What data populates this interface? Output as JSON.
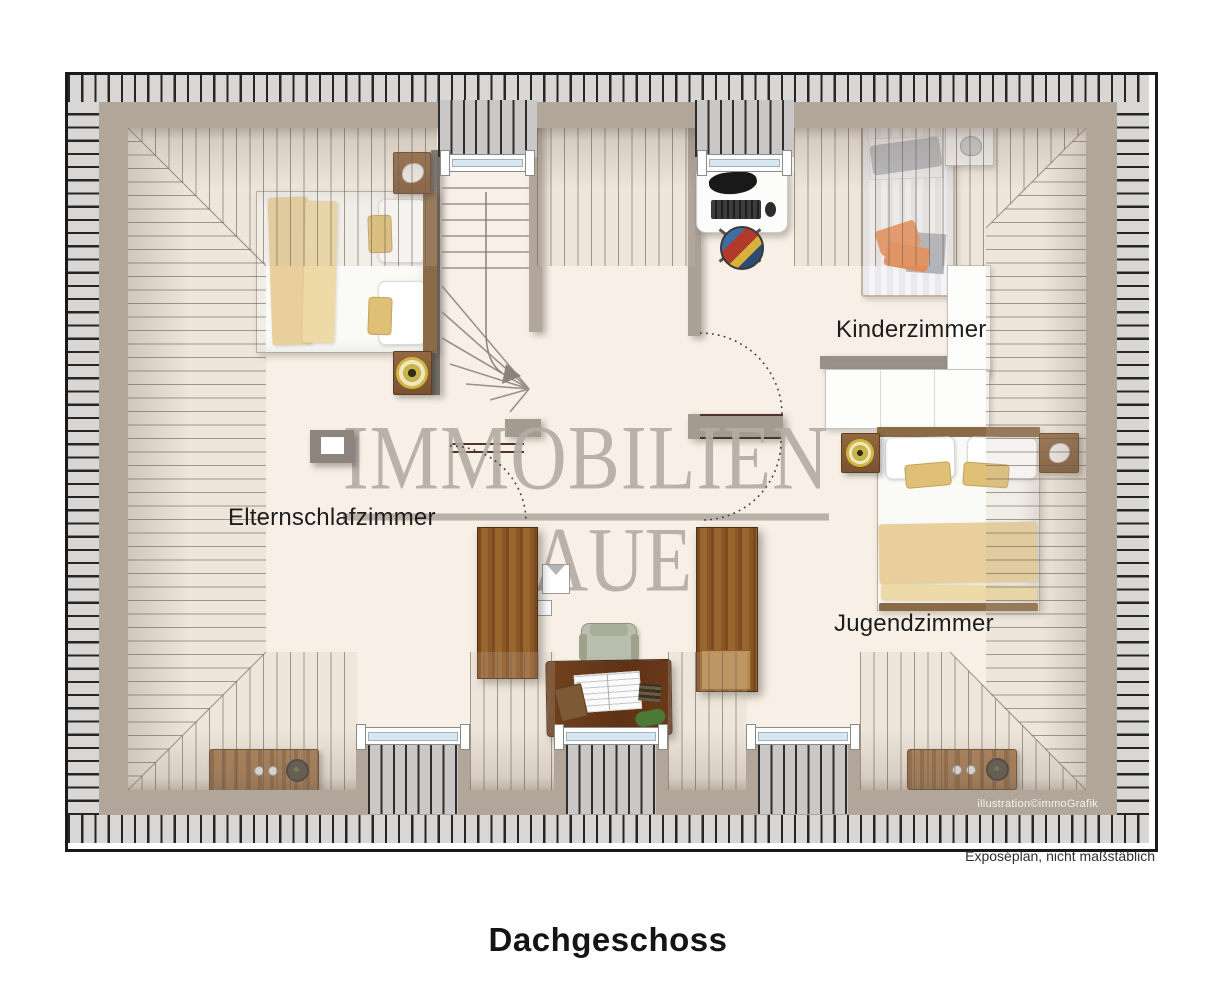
{
  "title": "Dachgeschoss",
  "watermark": {
    "line1": "IMMOBILIEN",
    "line2": "RAUE"
  },
  "rooms": {
    "kinderzimmer": {
      "label": "Kinderzimmer"
    },
    "elternschlafzimmer": {
      "label": "Elternschlafzimmer"
    },
    "jugendzimmer": {
      "label": "Jugendzimmer"
    }
  },
  "footer": {
    "disclaimer": "Exposéplan, nicht maßstäblich",
    "credit": "illustration©immoGrafik"
  },
  "colors": {
    "floor": "#f8f0e6",
    "eaves": "#d8d7d5",
    "eaves_line": "#262626",
    "wall": "#b2a69a",
    "linen": "#fafaf7",
    "blanket": "#e8cf9b",
    "cushion": "#dfc076",
    "glass": "#d7e6ef",
    "watermark": "#b5aca4",
    "accent_red": "#52332a",
    "label": "#1d1d1d",
    "dormer": "#c9c8c6",
    "orange": "#e8935f"
  }
}
